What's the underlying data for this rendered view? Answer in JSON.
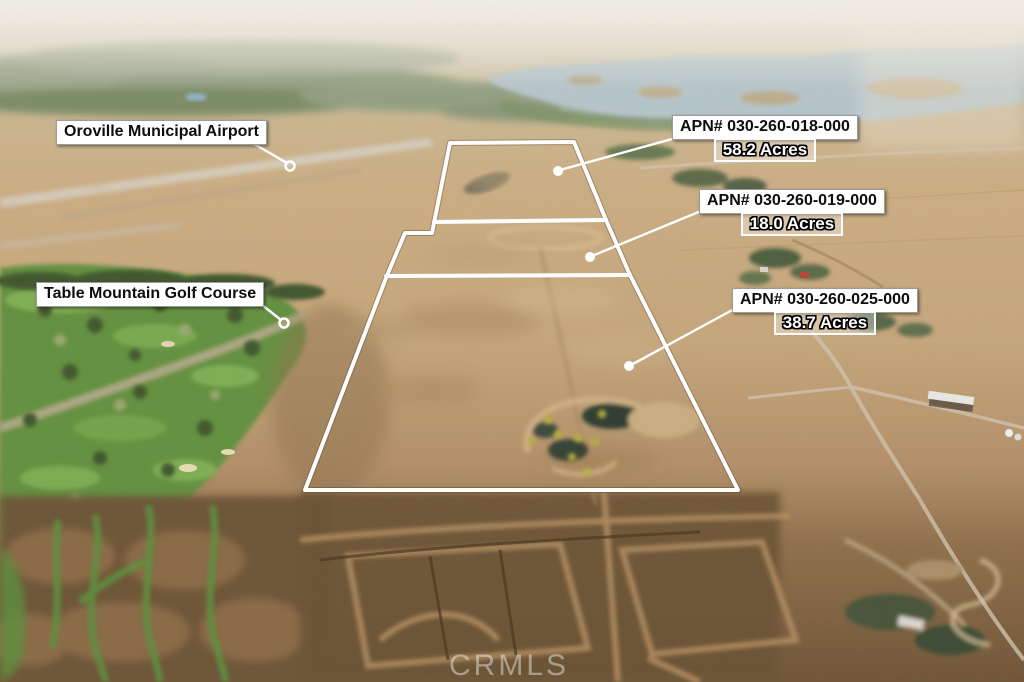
{
  "annotations": {
    "airport": {
      "label": "Oroville Municipal Airport"
    },
    "golf_course": {
      "label": "Table Mountain Golf Course"
    },
    "parcels": [
      {
        "apn": "APN# 030-260-018-000",
        "acres": "58.2 Acres"
      },
      {
        "apn": "APN# 030-260-019-000",
        "acres": "18.0 Acres"
      },
      {
        "apn": "APN# 030-260-025-000",
        "acres": "38.7 Acres"
      }
    ]
  },
  "watermark": {
    "text": "CRMLS"
  },
  "colors": {
    "boundary_line": "#ffffff",
    "label_background": "#ffffff",
    "label_text": "#111111",
    "acres_text": "#ffffff"
  }
}
